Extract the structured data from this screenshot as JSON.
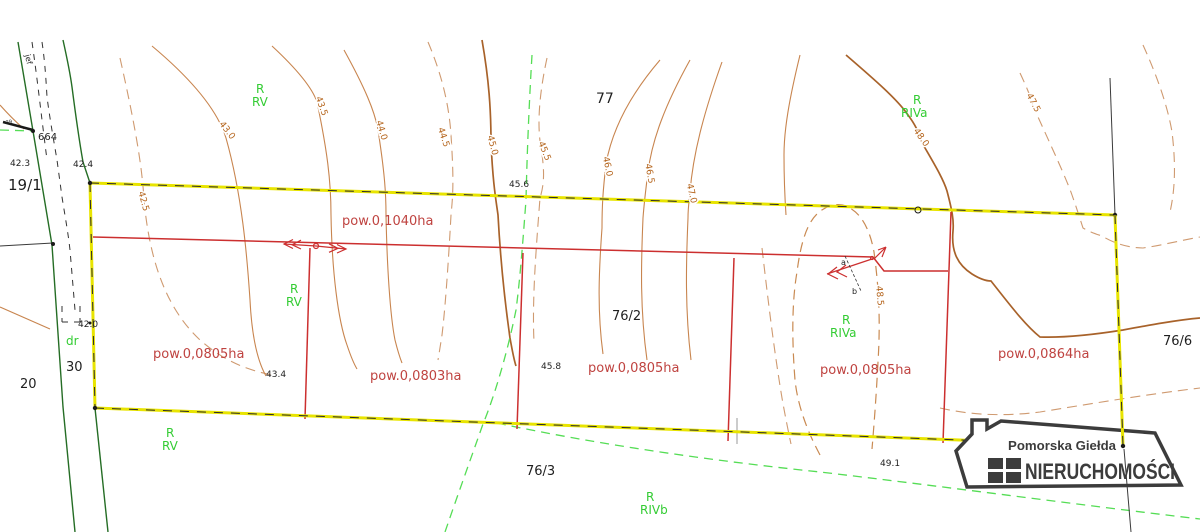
{
  "colors": {
    "boundary_yellow": "#e8e400",
    "division_red": "#cc2f2f",
    "area_label_red": "#bf4340",
    "contour_brown": "#c8854f",
    "land_use_green": "#33cc33",
    "road_green": "#256d25",
    "green_dashed": "#55dd55",
    "logo_gray": "#3c3c3c"
  },
  "parcel_numbers": {
    "p19_1": "19/1",
    "p20": "20",
    "p30": "30",
    "p77": "77",
    "p76_2": "76/2",
    "p76_3": "76/3",
    "p76_6": "76/6"
  },
  "area_labels": {
    "top": "pow.0,1040ha",
    "a1": "pow.0,0805ha",
    "a2": "pow.0,0803ha",
    "a3": "pow.0,0805ha",
    "a4": "pow.0,0805ha",
    "a5": "pow.0,0864ha"
  },
  "land_use": {
    "r": "R",
    "rv": "RV",
    "riva": "RIVa",
    "rivb": "RIVb",
    "dr": "dr"
  },
  "contour_labels": {
    "c425": "42.5",
    "c430": "43.0",
    "c435": "43.5",
    "c440": "44.0",
    "c445": "44.5",
    "c450": "45.0",
    "c455": "45.5",
    "c460": "46.0",
    "c465": "46.5",
    "c470": "47.0",
    "c475": "47.5",
    "c480": "48.0",
    "c485": "48.5"
  },
  "spot_heights": {
    "s664": "664",
    "s423": "42.3",
    "s424": "42.4",
    "s420": "42.0",
    "s456": "45.6",
    "s458": "45.8",
    "s434": "43.4",
    "s491": "49.1"
  },
  "annotations": {
    "a": "a",
    "b": "b",
    "jef": "jef",
    "s29": "29"
  },
  "logo": {
    "line1": "Pomorska Giełda",
    "line2": "NIERUCHOMOŚCI"
  }
}
